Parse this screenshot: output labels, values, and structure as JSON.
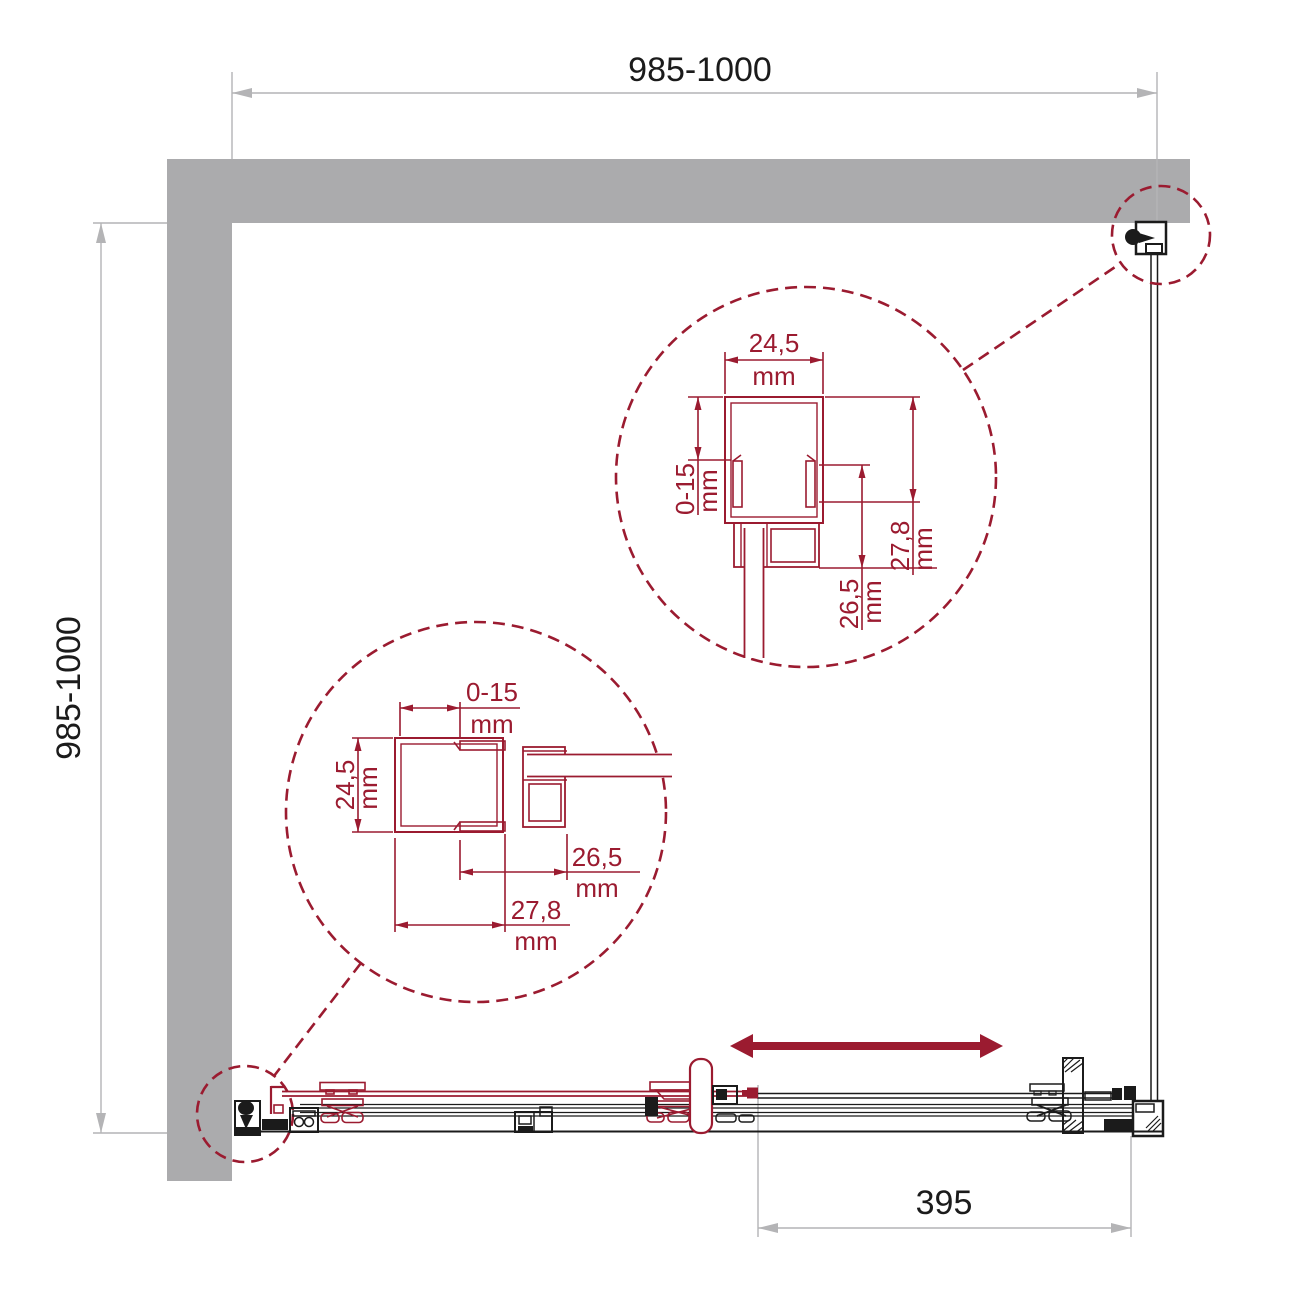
{
  "diagram": {
    "description": "Shower enclosure plan drawing with wall profile detail callouts",
    "colors": {
      "accent_red": "#9b1b30",
      "wall_gray": "#ababad",
      "dim_gray": "#b4b4b6",
      "line_black": "#1b1b1b"
    },
    "dims": {
      "width": {
        "value": "985-1000"
      },
      "depth": {
        "value": "985-1000"
      },
      "opening": {
        "value": "395"
      }
    },
    "detail_upper": {
      "profile_width": {
        "value": "24,5",
        "unit": "mm"
      },
      "adjustment": {
        "value": "0-15",
        "unit": "mm"
      },
      "profile_depth": {
        "value": "27,8",
        "unit": "mm"
      },
      "inner_depth": {
        "value": "26,5",
        "unit": "mm"
      }
    },
    "detail_lower": {
      "adjustment": {
        "value": "0-15",
        "unit": "mm"
      },
      "profile_width": {
        "value": "24,5",
        "unit": "mm"
      },
      "inner_depth": {
        "value": "26,5",
        "unit": "mm"
      },
      "profile_depth": {
        "value": "27,8",
        "unit": "mm"
      }
    }
  }
}
